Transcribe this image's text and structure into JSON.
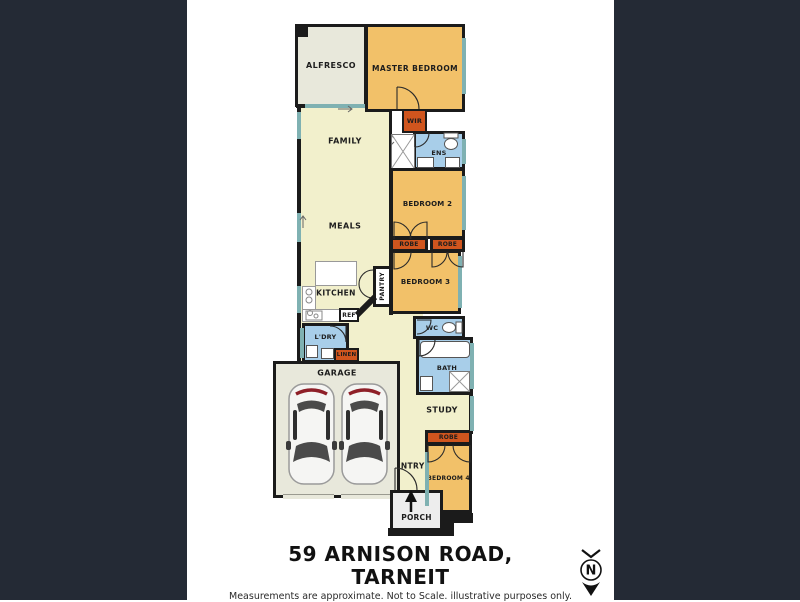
{
  "title": {
    "line1": "59 ARNISON ROAD,",
    "line2": "TARNEIT"
  },
  "disclaimer": "Measurements are approximate. Not to Scale. illustrative purposes only.",
  "compass": {
    "label": "N"
  },
  "rooms": {
    "alfresco": "ALFRESCO",
    "master_bedroom": "MASTER BEDROOM",
    "wir": "WIR",
    "ens": "ENS",
    "family": "FAMILY",
    "meals": "MEALS",
    "bedroom2": "BEDROOM 2",
    "robe_left": "ROBE",
    "robe_right": "ROBE",
    "bedroom3": "BEDROOM 3",
    "kitchen": "KITCHEN",
    "pantry": "PANTRY",
    "ref": "REF",
    "ldry": "L'DRY",
    "linen": "LINEN",
    "wc": "WC",
    "bath": "BATH",
    "garage": "GARAGE",
    "study": "STUDY",
    "robe4": "ROBE",
    "bedroom4": "BEDROOM 4",
    "entry": "ENTRY",
    "porch": "PORCH"
  },
  "colors": {
    "background": "#242a35",
    "canvas": "#ffffff",
    "wall": "#1b1b1b",
    "bedroom_fill": "#f2c169",
    "robe_fill": "#d0551e",
    "wet_area_fill": "#a8cee9",
    "living_fill": "#f2f0cc",
    "outdoor_fill": "#e8e8db",
    "window_strip": "#7fb1b2",
    "porch_fill": "#ededed"
  }
}
